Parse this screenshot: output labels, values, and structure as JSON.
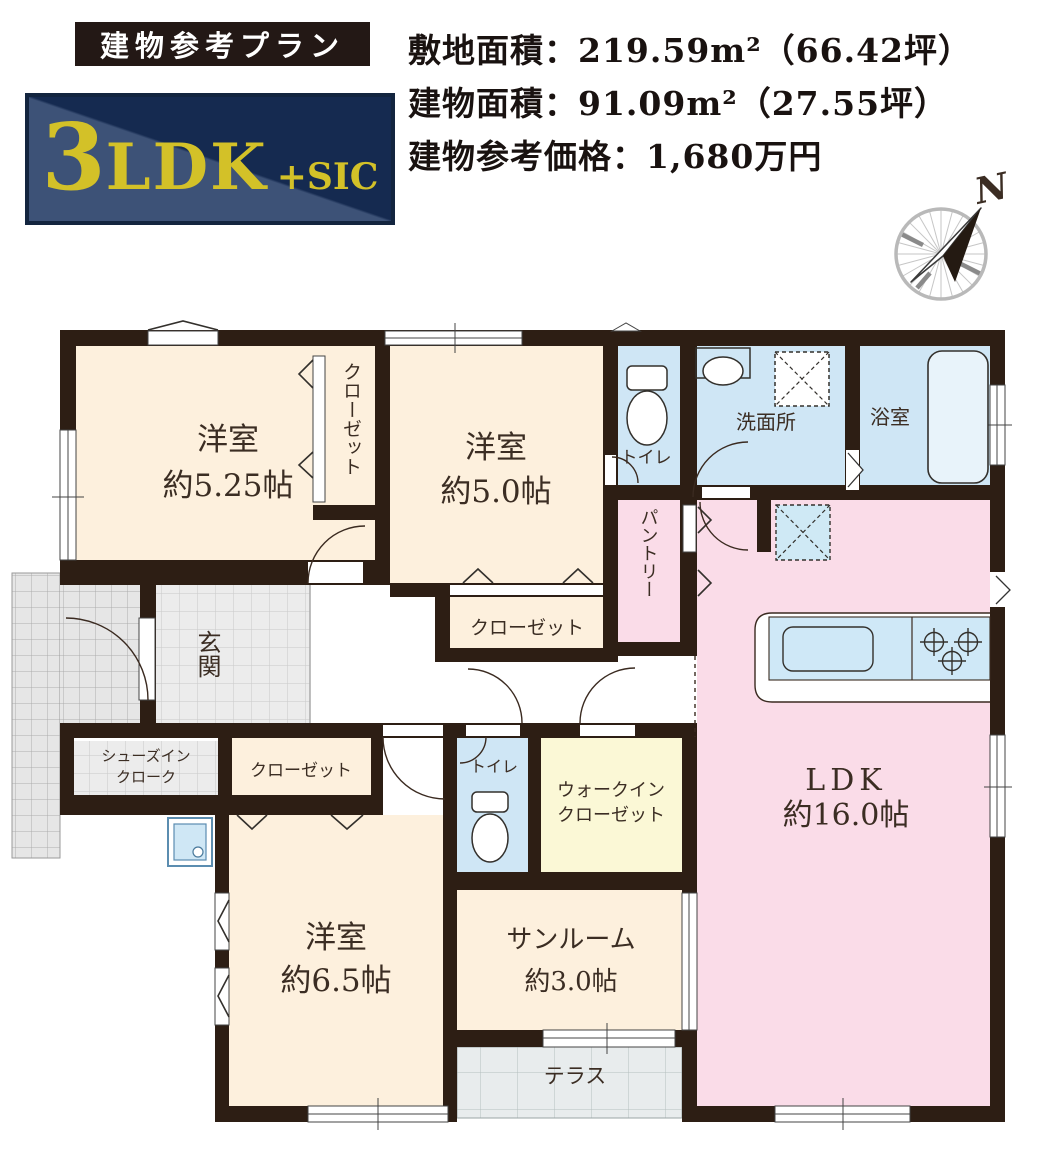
{
  "header": {
    "banner": "建物参考プラン",
    "badge": {
      "num": "3",
      "type": "LDK",
      "suffix": "+SIC"
    },
    "specs": {
      "site": "敷地面積：219.59m²（66.42坪）",
      "building": "建物面積：91.09m²（27.55坪）",
      "price": "建物参考価格：1,680万円"
    },
    "compass_n": "N"
  },
  "floorplan": {
    "rooms": {
      "bedroom1": {
        "name": "洋室",
        "size": "約5.25帖"
      },
      "bedroom2": {
        "name": "洋室",
        "size": "約5.0帖"
      },
      "bedroom3": {
        "name": "洋室",
        "size": "約6.5帖"
      },
      "ldk": {
        "name": "LDK",
        "size": "約16.0帖"
      },
      "sunroom": {
        "name": "サンルーム",
        "size": "約3.0帖"
      },
      "closet1": {
        "name": "クローゼット"
      },
      "closet2": {
        "name": "クローゼット"
      },
      "closet3": {
        "name": "クローゼット"
      },
      "walkin_closet": {
        "line1": "ウォークイン",
        "line2": "クローゼット"
      },
      "pantry": {
        "name": "パントリー"
      },
      "entrance": {
        "name": "玄関"
      },
      "shoes_in_closet": {
        "line1": "シューズイン",
        "line2": "クローク"
      },
      "toilet1": {
        "name": "トイレ"
      },
      "toilet2": {
        "name": "トイレ"
      },
      "washroom": {
        "name": "洗面所"
      },
      "bathroom": {
        "name": "浴室"
      },
      "terrace": {
        "name": "テラス"
      }
    },
    "colors": {
      "wall": "#2d1e14",
      "room_cream": "#fdf0dd",
      "room_pink": "#fadce8",
      "room_blue": "#cfe6f5",
      "room_yellow": "#fbf8d6",
      "tile_gray": "#ececec",
      "badge_navy_dark": "#152a50",
      "badge_navy_light": "#3d5277",
      "badge_yellow": "#d3c128",
      "banner_bg": "#231815"
    }
  }
}
